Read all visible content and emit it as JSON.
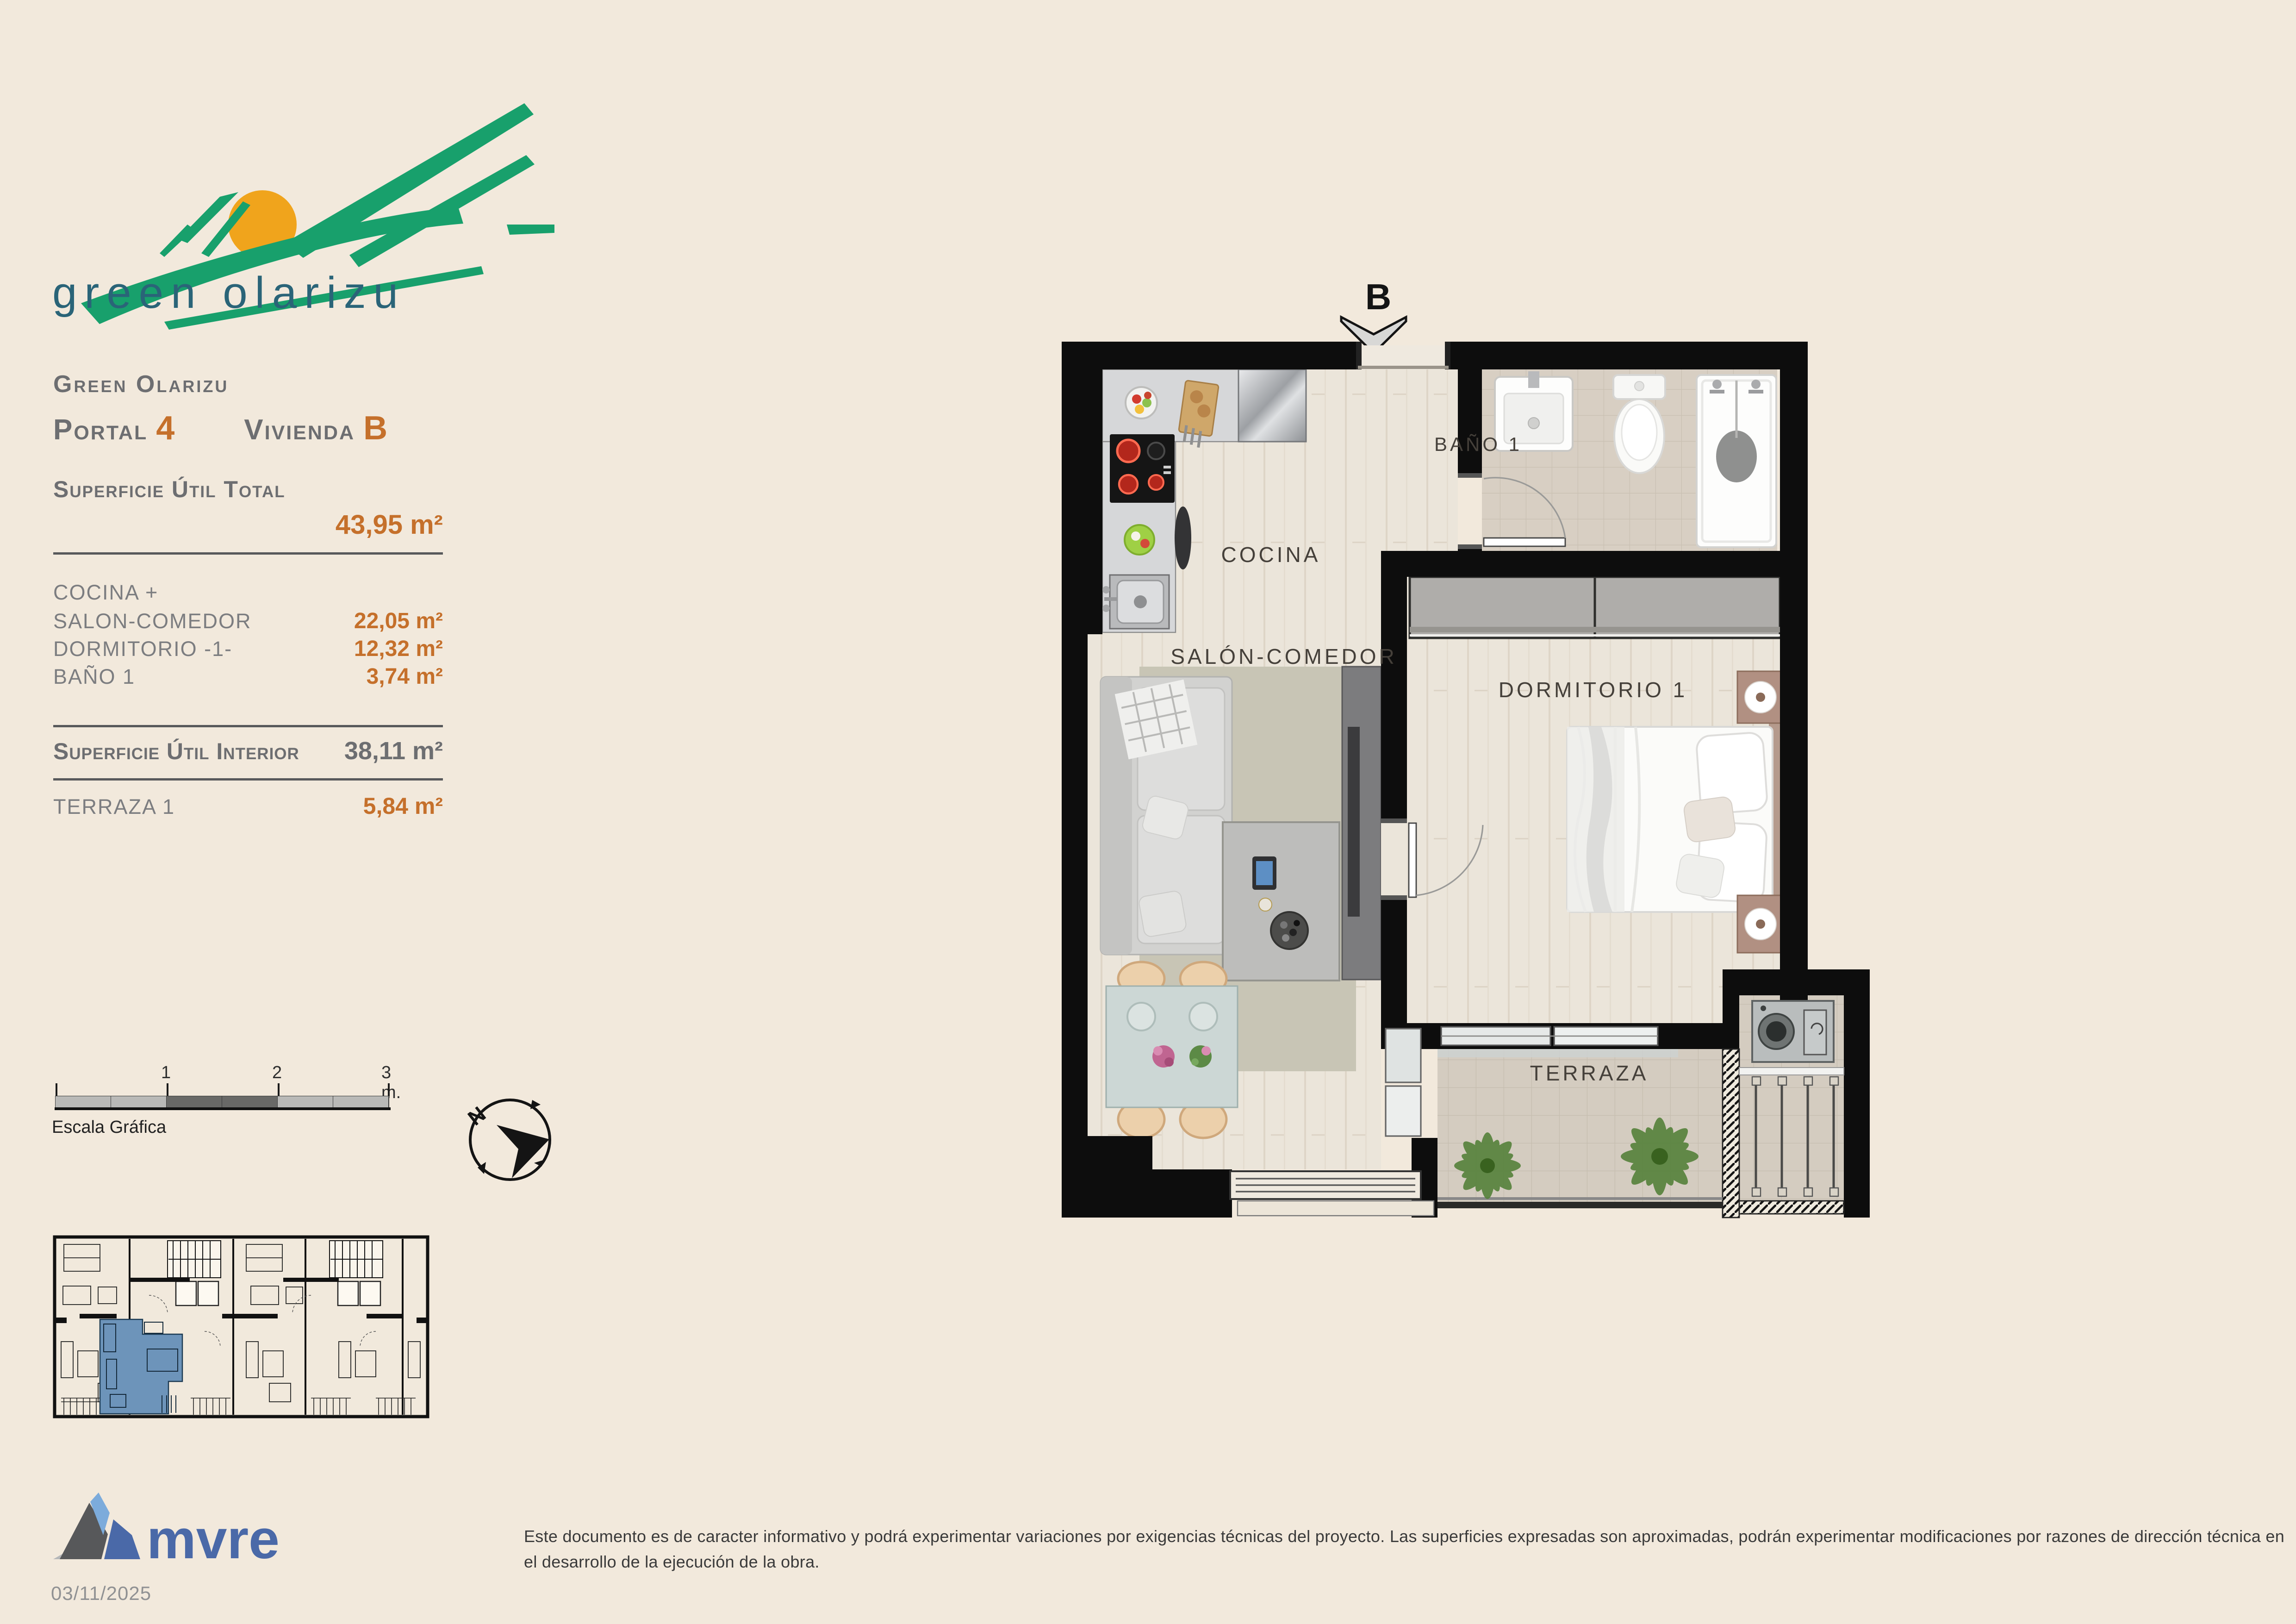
{
  "logo": {
    "wordmark": "green olarizu"
  },
  "header": {
    "project_name": "Green Olarizu",
    "portal_label": "Portal",
    "portal_number": "4",
    "vivienda_label": "Vivienda",
    "vivienda_letter": "B"
  },
  "summary": {
    "total_label": "Superficie Útil Total",
    "total_value": "43,95 m²",
    "rows": [
      {
        "label": "COCINA +",
        "value": ""
      },
      {
        "label": "SALON-COMEDOR",
        "value": "22,05 m²"
      },
      {
        "label": "DORMITORIO -1-",
        "value": "12,32 m²"
      },
      {
        "label": "BAÑO 1",
        "value": "3,74 m²"
      }
    ],
    "interior_label": "Superficie Útil Interior",
    "interior_value": "38,11 m²",
    "terrace_label": "TERRAZA 1",
    "terrace_value": "5,84 m²"
  },
  "plan": {
    "entrance_label": "B",
    "rooms": {
      "cocina": "COCINA",
      "salon": "SALÓN-COMEDOR",
      "bano": "BAÑO 1",
      "dormitorio": "DORMITORIO 1",
      "terraza": "TERRAZA"
    }
  },
  "scale_bar": {
    "label": "Escala Gráfica",
    "ticks": [
      "1",
      "2",
      "3 m."
    ]
  },
  "compass": {
    "north_label": "N"
  },
  "footer": {
    "brand": "mvre",
    "date": "03/11/2025",
    "disclaimer": "Este documento es de caracter informativo y podrá experimentar variaciones por exigencias técnicas del proyecto. Las superficies expresadas son aproximadas, podrán experimentar modificaciones por razones de dirección técnica en el desarrollo de la ejecución de la obra."
  },
  "colors": {
    "accent_orange": "#c5702b",
    "text_gray": "#6d6e71",
    "logo_green": "#18a06c",
    "logo_sun": "#f0a41c",
    "logo_text": "#2a6478",
    "brand_blue": "#4a69a8",
    "highlight_blue": "#6d94ba",
    "wall_black": "#0d0d0d"
  }
}
